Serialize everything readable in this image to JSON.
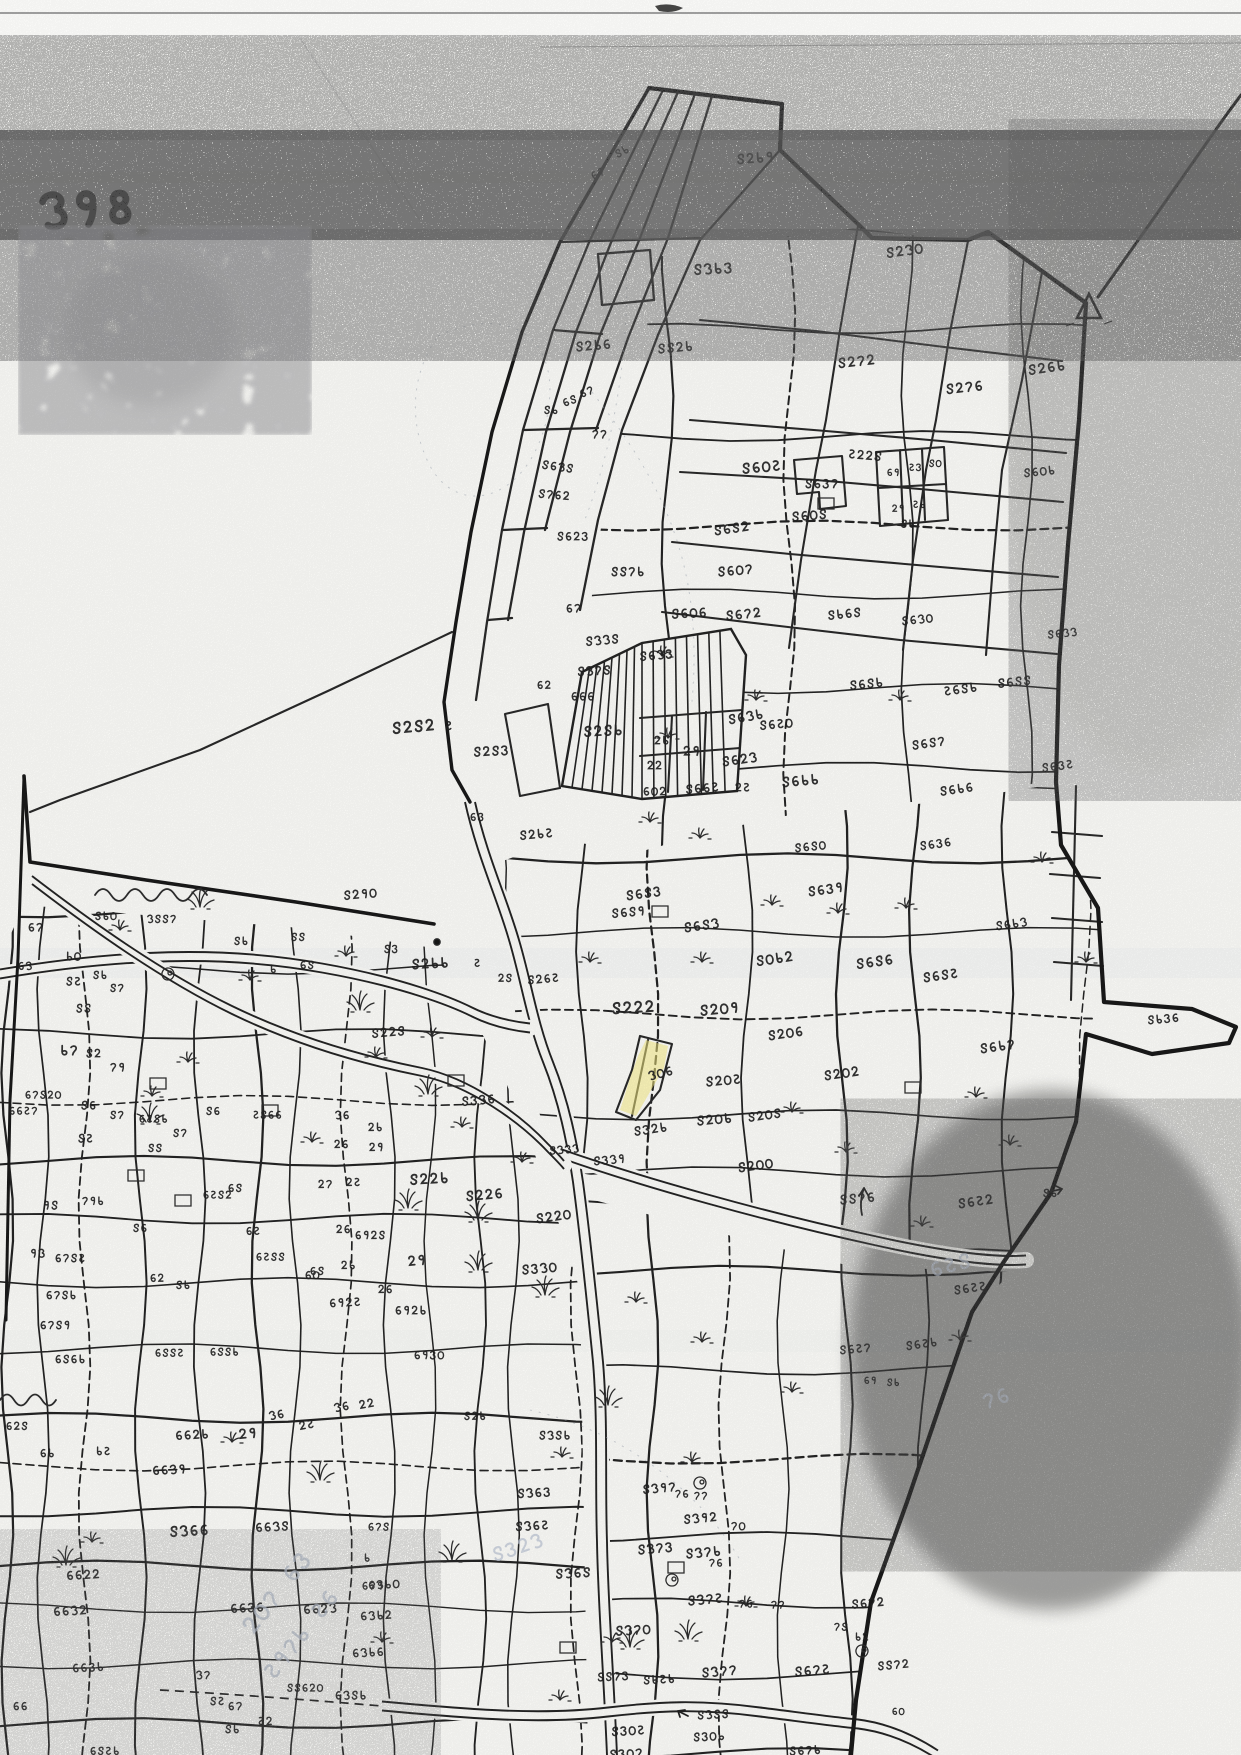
{
  "page": {
    "sheet_number": "১98",
    "document_kind": "Scanned hand-drawn cadastral (mouza) plot map, Bengali numerals"
  },
  "map": {
    "colors": {
      "ink": "#1f1f1f",
      "boundary": "#151515",
      "paper": "#f6f6f3",
      "highlight": "#f2e87e",
      "pencil": "#b9c1cf",
      "noise": "#222222"
    },
    "highlighted_plot": {
      "label": "১০৬"
    },
    "survey_marks": [
      "triangle-station",
      "north-arrow-small"
    ],
    "labels": [
      [
        "৪৮",
        612,
        150,
        0.8,
        -28
      ],
      [
        "৬৭",
        588,
        172,
        0.8,
        -28
      ],
      [
        "৪২৮৯",
        735,
        152,
        1,
        -4
      ],
      [
        "৪২১০",
        884,
        246,
        1,
        -8
      ],
      [
        "৪১৮৩",
        692,
        262,
        1.05,
        -3
      ],
      [
        "৬৪",
        560,
        398,
        0.8,
        -20
      ],
      [
        "৬৭",
        577,
        389,
        0.8,
        -20
      ],
      [
        "৪২৮৬",
        574,
        340,
        0.95,
        -5
      ],
      [
        "৪৪২৮",
        656,
        342,
        0.95,
        -5
      ],
      [
        "৪২৭২",
        836,
        356,
        1,
        -6
      ],
      [
        "৪২৭৬",
        944,
        382,
        1,
        -6
      ],
      [
        "৪২৬৮",
        1026,
        363,
        1,
        -8
      ],
      [
        "৪৮",
        543,
        404,
        0.8,
        0
      ],
      [
        "৭৭",
        591,
        428,
        0.85,
        0
      ],
      [
        "৪৬১৪",
        542,
        458,
        0.85,
        8
      ],
      [
        "৪৭৬২",
        538,
        487,
        0.85,
        5
      ],
      [
        "৪৬০৫",
        740,
        461,
        1.05,
        -5
      ],
      [
        "৪৬০৪",
        790,
        510,
        0.95,
        -5
      ],
      [
        "৪৬৪২",
        712,
        524,
        0.95,
        -8
      ],
      [
        "৪৬০৭",
        716,
        565,
        0.95,
        -5
      ],
      [
        "৪৪৭৮",
        610,
        565,
        0.9,
        0
      ],
      [
        "৪৬২৩",
        556,
        530,
        0.85,
        0
      ],
      [
        "৬৭",
        565,
        602,
        0.85,
        0
      ],
      [
        "৪৬০৬",
        670,
        607,
        0.95,
        -3
      ],
      [
        "৪৬৭২",
        724,
        609,
        0.95,
        -6
      ],
      [
        "৪১১৪",
        584,
        635,
        0.9,
        -5
      ],
      [
        "৪১৭৪",
        576,
        665,
        0.9,
        -3
      ],
      [
        "৬২",
        536,
        679,
        0.8,
        0
      ],
      [
        "৬৬৬",
        570,
        690,
        0.85,
        0
      ],
      [
        "৪৬১৩",
        638,
        650,
        0.9,
        -5
      ],
      [
        "৪২৪৮",
        582,
        724,
        1.05,
        -3
      ],
      [
        "৪২৪২",
        390,
        720,
        1.15,
        -5
      ],
      [
        "৫",
        444,
        719,
        0.9,
        0
      ],
      [
        "৪২৪৩",
        472,
        745,
        0.95,
        -3
      ],
      [
        "৪৬১৮",
        726,
        713,
        0.95,
        -10
      ],
      [
        "২৮",
        653,
        734,
        0.85,
        0
      ],
      [
        "২৯",
        682,
        744,
        0.95,
        0
      ],
      [
        "২২",
        646,
        759,
        0.85,
        0
      ],
      [
        "৪৬২১",
        720,
        755,
        0.95,
        -8
      ],
      [
        "৬০২",
        642,
        785,
        0.85,
        0
      ],
      [
        "৪৬৬৫",
        684,
        783,
        0.9,
        -5
      ],
      [
        "২৫",
        734,
        781,
        0.85,
        0
      ],
      [
        "৪৮৬৪",
        826,
        609,
        0.9,
        -6
      ],
      [
        "৪৬১০",
        900,
        615,
        0.85,
        -6
      ],
      [
        "৫২২৪",
        848,
        447,
        0.9,
        5
      ],
      [
        "৪৬৩৭",
        804,
        477,
        0.9,
        0
      ],
      [
        "৬৯",
        886,
        467,
        0.72,
        0
      ],
      [
        "৫৩",
        908,
        462,
        0.72,
        0
      ],
      [
        "৪০",
        928,
        458,
        0.72,
        0
      ],
      [
        "২৯",
        891,
        503,
        0.72,
        0
      ],
      [
        "৫৮",
        912,
        499,
        0.72,
        0
      ],
      [
        "৪৮",
        900,
        518,
        0.78,
        0
      ],
      [
        "৪৬০৮",
        1022,
        467,
        0.85,
        -6
      ],
      [
        "৪৬৪৪",
        996,
        677,
        0.9,
        -6
      ],
      [
        "৫৬৪৮",
        942,
        685,
        0.9,
        -8
      ],
      [
        "৪৬৪৮",
        848,
        679,
        0.9,
        -6
      ],
      [
        "৪৬৪৭",
        910,
        739,
        0.9,
        -8
      ],
      [
        "৪৬৮৮",
        780,
        775,
        1,
        -5
      ],
      [
        "৪৬৮৬",
        938,
        785,
        0.9,
        -8
      ],
      [
        "৪৬১১",
        1046,
        629,
        0.8,
        -6
      ],
      [
        "৪৬৩৫",
        1040,
        762,
        0.85,
        -8
      ],
      [
        "৪৬৫০",
        758,
        719,
        0.9,
        -5
      ],
      [
        "৬৩",
        469,
        811,
        0.8,
        0
      ],
      [
        "৪২৮৫",
        518,
        829,
        0.9,
        -5
      ],
      [
        "৪২৯০",
        342,
        889,
        0.9,
        -5
      ],
      [
        "৪৬৪৩",
        624,
        889,
        0.95,
        -8
      ],
      [
        "৪৬৪৯",
        610,
        907,
        0.9,
        -5
      ],
      [
        "৪৬৪১",
        682,
        921,
        0.95,
        -8
      ],
      [
        "৪০৮২",
        754,
        954,
        1,
        -8
      ],
      [
        "৪৬৪০",
        793,
        842,
        0.85,
        -6
      ],
      [
        "৪৬৩৬",
        918,
        840,
        0.85,
        -8
      ],
      [
        "৪৬৩৯",
        806,
        885,
        0.95,
        -8
      ],
      [
        "৪৬৪৬",
        854,
        957,
        1,
        -8
      ],
      [
        "৪৬৪৫",
        921,
        971,
        0.95,
        -8
      ],
      [
        "৪৬৮১",
        994,
        920,
        0.85,
        -8
      ],
      [
        "১৪৪৭",
        146,
        913,
        0.8,
        0
      ],
      [
        "৪৮",
        233,
        935,
        0.8,
        0
      ],
      [
        "৪৪",
        290,
        931,
        0.8,
        0
      ],
      [
        "৮",
        269,
        963,
        0.8,
        0
      ],
      [
        "৬৪",
        299,
        959,
        0.8,
        0
      ],
      [
        "৪২৮৮",
        410,
        957,
        1,
        -3
      ],
      [
        "৫",
        473,
        957,
        0.8,
        0
      ],
      [
        "২৪",
        497,
        972,
        0.8,
        0
      ],
      [
        "৪২৬৫",
        526,
        974,
        0.85,
        -5
      ],
      [
        "৪৩",
        383,
        943,
        0.8,
        0
      ],
      [
        "৪২২৪",
        370,
        1027,
        0.9,
        -5
      ],
      [
        "৬৭",
        27,
        921,
        0.85,
        0
      ],
      [
        "৪৮০",
        94,
        910,
        0.8,
        0
      ],
      [
        "৮০",
        65,
        950,
        0.85,
        0
      ],
      [
        "৬১",
        17,
        960,
        0.8,
        0
      ],
      [
        "৪৫",
        65,
        975,
        0.85,
        0
      ],
      [
        "৪৮",
        92,
        969,
        0.8,
        0
      ],
      [
        "৪৭",
        109,
        982,
        0.8,
        0
      ],
      [
        "৪৪",
        75,
        1002,
        0.85,
        0
      ],
      [
        "৮৭",
        59,
        1043,
        1,
        0
      ],
      [
        "৪২",
        85,
        1047,
        0.85,
        0
      ],
      [
        "৭৯",
        109,
        1061,
        0.85,
        0
      ],
      [
        "৬৭৪২০",
        24,
        1089,
        0.78,
        0
      ],
      [
        "৬৬৫৭",
        8,
        1105,
        0.78,
        0
      ],
      [
        "৪৬",
        80,
        1099,
        0.85,
        0
      ],
      [
        "৪৫",
        77,
        1132,
        0.85,
        0
      ],
      [
        "৪৭",
        109,
        1109,
        0.8,
        0
      ],
      [
        "৯৪",
        42,
        1199,
        0.85,
        0
      ],
      [
        "৭৯৮",
        81,
        1195,
        0.8,
        0
      ],
      [
        "৪৬",
        132,
        1222,
        0.8,
        0
      ],
      [
        "৯১",
        29,
        1247,
        0.85,
        0
      ],
      [
        "৬৭৪৫",
        54,
        1252,
        0.82,
        0
      ],
      [
        "৬৭৪৮",
        45,
        1289,
        0.82,
        0
      ],
      [
        "৬২",
        149,
        1272,
        0.8,
        0
      ],
      [
        "৪৮",
        175,
        1279,
        0.8,
        0
      ],
      [
        "৬৫৪৮",
        138,
        1113,
        0.78,
        0
      ],
      [
        "৪৪",
        147,
        1142,
        0.8,
        0
      ],
      [
        "৪৭",
        172,
        1127,
        0.8,
        0
      ],
      [
        "৪৬",
        205,
        1105,
        0.8,
        0
      ],
      [
        "৬৫৪২",
        202,
        1189,
        0.78,
        0
      ],
      [
        "৫৪৬৬",
        252,
        1109,
        0.78,
        0
      ],
      [
        "৬৪",
        227,
        1182,
        0.8,
        0
      ],
      [
        "৬৫",
        245,
        1225,
        0.8,
        0
      ],
      [
        "৬৫৪৪",
        255,
        1251,
        0.78,
        0
      ],
      [
        "৬৪",
        309,
        1265,
        0.8,
        0
      ],
      [
        "৬৭৪৯",
        39,
        1319,
        0.82,
        0
      ],
      [
        "৬৪৬৮",
        54,
        1353,
        0.82,
        0
      ],
      [
        "৬২৪",
        5,
        1420,
        0.8,
        0
      ],
      [
        "৬৮",
        39,
        1447,
        0.82,
        0
      ],
      [
        "৮৫",
        95,
        1445,
        0.82,
        0
      ],
      [
        "৬৪৪৫",
        154,
        1347,
        0.78,
        0
      ],
      [
        "৬৪৪৮",
        209,
        1346,
        0.78,
        0
      ],
      [
        "৪৩১৬",
        460,
        1095,
        0.9,
        -5
      ],
      [
        "১৬",
        334,
        1109,
        0.82,
        0
      ],
      [
        "২৮",
        367,
        1121,
        0.82,
        0
      ],
      [
        "২৬",
        333,
        1138,
        0.82,
        0
      ],
      [
        "২৯",
        368,
        1141,
        0.82,
        0
      ],
      [
        "২৫",
        345,
        1176,
        0.82,
        0
      ],
      [
        "২৭",
        317,
        1178,
        0.82,
        0
      ],
      [
        "৪২২৮",
        408,
        1172,
        1.05,
        -3
      ],
      [
        "৪২২৬",
        464,
        1189,
        1,
        -5
      ],
      [
        "৪২২০",
        534,
        1212,
        0.95,
        -8
      ],
      [
        "৪১১১",
        548,
        1145,
        0.8,
        -5
      ],
      [
        "২৬",
        335,
        1223,
        0.82,
        0
      ],
      [
        "২৮",
        340,
        1259,
        0.82,
        0
      ],
      [
        "৬০",
        304,
        1269,
        0.82,
        0
      ],
      [
        "২৯",
        406,
        1254,
        1,
        -5
      ],
      [
        "২৬",
        377,
        1283,
        0.82,
        0
      ],
      [
        "৪৩১০",
        520,
        1263,
        0.95,
        -5
      ],
      [
        "৬৯২৫",
        328,
        1297,
        0.85,
        -3
      ],
      [
        "৬৯২৪",
        354,
        1229,
        0.82,
        0
      ],
      [
        "৬৯২৮",
        394,
        1304,
        0.85,
        0
      ],
      [
        "৬৯৩০",
        413,
        1349,
        0.82,
        0
      ],
      [
        "৪২৮",
        463,
        1410,
        0.8,
        0
      ],
      [
        "৪১৪৮",
        538,
        1429,
        0.85,
        0
      ],
      [
        "৪৩১৯",
        592,
        1155,
        0.85,
        -5
      ],
      [
        "১০৬",
        646,
        1070,
        0.9,
        -14
      ],
      [
        "৪৩২৮",
        632,
        1125,
        0.9,
        -8
      ],
      [
        "৪২০৯",
        698,
        1003,
        1.05,
        -5
      ],
      [
        "৪২০৬",
        766,
        1029,
        0.95,
        -8
      ],
      [
        "৪২০৫",
        704,
        1075,
        0.95,
        -5
      ],
      [
        "৪২০৮",
        695,
        1114,
        0.95,
        -5
      ],
      [
        "৪২০৪",
        746,
        1111,
        0.9,
        -8
      ],
      [
        "৪২০০",
        736,
        1161,
        0.95,
        -8
      ],
      [
        "৪২২২",
        610,
        1000,
        1.15,
        -3
      ],
      [
        "৪২০২",
        822,
        1069,
        0.95,
        -8
      ],
      [
        "৪৬৮৭",
        978,
        1042,
        0.95,
        -8
      ],
      [
        "৪৮৩৬",
        1146,
        1014,
        0.85,
        -5
      ],
      [
        "৪৪৭৬",
        838,
        1193,
        0.95,
        -5
      ],
      [
        "৪৬৫২",
        956,
        1197,
        0.95,
        -8
      ],
      [
        "৪৮",
        1042,
        1187,
        0.8,
        0
      ],
      [
        "৪৬৫৫",
        952,
        1284,
        0.88,
        -8
      ],
      [
        "৪৬৫৮",
        904,
        1340,
        0.85,
        -8
      ],
      [
        "৪৬৫৭",
        838,
        1344,
        0.85,
        -5
      ],
      [
        "৬৯",
        863,
        1375,
        0.72,
        0
      ],
      [
        "৪৮",
        886,
        1377,
        0.72,
        0
      ],
      [
        "৬৬২৮",
        174,
        1429,
        0.9,
        -3
      ],
      [
        "৬৬১৯",
        151,
        1464,
        0.9,
        -3
      ],
      [
        "২৯",
        237,
        1427,
        1,
        -5
      ],
      [
        "১৬",
        267,
        1410,
        0.85,
        -10
      ],
      [
        "২৫",
        297,
        1420,
        0.85,
        -10
      ],
      [
        "১৬",
        332,
        1402,
        0.85,
        -10
      ],
      [
        "২২",
        357,
        1399,
        0.85,
        -10
      ],
      [
        "৬৬১৪",
        254,
        1521,
        0.9,
        -3
      ],
      [
        "৪১৬৬",
        168,
        1524,
        1.05,
        -3
      ],
      [
        "৬৭৪",
        367,
        1521,
        0.78,
        0
      ],
      [
        "৮",
        363,
        1552,
        0.78,
        0
      ],
      [
        "৬৭৯",
        361,
        1580,
        0.78,
        0
      ],
      [
        "৬৬২২",
        65,
        1569,
        0.9,
        -3
      ],
      [
        "৬৬১২",
        52,
        1605,
        0.9,
        -3
      ],
      [
        "৬৬৩৮",
        71,
        1662,
        0.85,
        -3
      ],
      [
        "৬৬৩৬",
        229,
        1602,
        0.9,
        -3
      ],
      [
        "৬৬২১",
        302,
        1603,
        0.9,
        -3
      ],
      [
        "৬১৮০",
        367,
        1579,
        0.85,
        -3
      ],
      [
        "৬১৮২",
        359,
        1610,
        0.85,
        -3
      ],
      [
        "৬১৮৬",
        351,
        1647,
        0.85,
        -3
      ],
      [
        "১৭",
        195,
        1669,
        0.82,
        0
      ],
      [
        "৪৫",
        209,
        1695,
        0.82,
        0
      ],
      [
        "৬৭",
        227,
        1700,
        0.82,
        0
      ],
      [
        "৪৮",
        224,
        1723,
        0.82,
        0
      ],
      [
        "৫২",
        257,
        1715,
        0.82,
        0
      ],
      [
        "৪৪৬২০",
        286,
        1682,
        0.78,
        0
      ],
      [
        "৬১৪৮",
        334,
        1689,
        0.85,
        0
      ],
      [
        "৬৬",
        12,
        1700,
        0.82,
        0
      ],
      [
        "৬৪৫৮",
        89,
        1745,
        0.8,
        0
      ],
      [
        "৪১৬৩",
        516,
        1487,
        0.9,
        -3
      ],
      [
        "৪১৬৫",
        514,
        1520,
        0.9,
        -3
      ],
      [
        "৪১৬৪",
        554,
        1567,
        0.95,
        -3
      ],
      [
        "৪১৯৭",
        641,
        1483,
        0.9,
        -5
      ],
      [
        "৭৬",
        674,
        1488,
        0.78,
        0
      ],
      [
        "৭৭",
        693,
        1490,
        0.78,
        0
      ],
      [
        "৪১৯২",
        682,
        1513,
        0.9,
        -5
      ],
      [
        "৭০",
        730,
        1520,
        0.82,
        0
      ],
      [
        "৪১৭৩",
        636,
        1543,
        0.95,
        -5
      ],
      [
        "৪১৭৮",
        684,
        1547,
        0.95,
        -5
      ],
      [
        "৭৬",
        708,
        1557,
        0.78,
        0
      ],
      [
        "৪১৭৫",
        686,
        1594,
        0.95,
        -5
      ],
      [
        "৭৬",
        738,
        1598,
        0.78,
        0
      ],
      [
        "৭৭",
        770,
        1599,
        0.78,
        0
      ],
      [
        "৪৬৭২",
        850,
        1598,
        0.88,
        -5
      ],
      [
        "৭৪",
        833,
        1621,
        0.78,
        0
      ],
      [
        "৮২",
        854,
        1631,
        0.78,
        0
      ],
      [
        "৪১৭০",
        614,
        1624,
        0.95,
        -3
      ],
      [
        "৪৬৭৫",
        793,
        1665,
        0.95,
        -5
      ],
      [
        "৪৪৭২",
        876,
        1660,
        0.85,
        -5
      ],
      [
        "৬০",
        891,
        1706,
        0.72,
        0
      ],
      [
        "৪৪৭৩",
        596,
        1671,
        0.85,
        -3
      ],
      [
        "৪৮৫৮",
        642,
        1674,
        0.85,
        -3
      ],
      [
        "৪১৭৭",
        700,
        1666,
        0.95,
        -5
      ],
      [
        "৪১৪৪",
        696,
        1709,
        0.85,
        -3
      ],
      [
        "৪৩০৫",
        610,
        1725,
        0.9,
        -3
      ],
      [
        "৪৩০৮",
        692,
        1731,
        0.85,
        -3
      ],
      [
        "৪৩০৭",
        608,
        1748,
        0.9,
        -3
      ],
      [
        "৪৬৭৮",
        788,
        1745,
        0.85,
        -3
      ]
    ],
    "ghost_pencil_notes": [
      [
        "২০৭ ৬৩",
        236,
        1624,
        1.7,
        -52
      ],
      [
        "৫৯৭৮ ৫৬",
        258,
        1670,
        1.6,
        -52
      ],
      [
        "৬৫৪",
        926,
        1260,
        1.5,
        -15
      ],
      [
        "৪৩২১",
        488,
        1546,
        1.4,
        -18
      ],
      [
        "৭৬",
        978,
        1393,
        1.5,
        -20
      ]
    ]
  }
}
